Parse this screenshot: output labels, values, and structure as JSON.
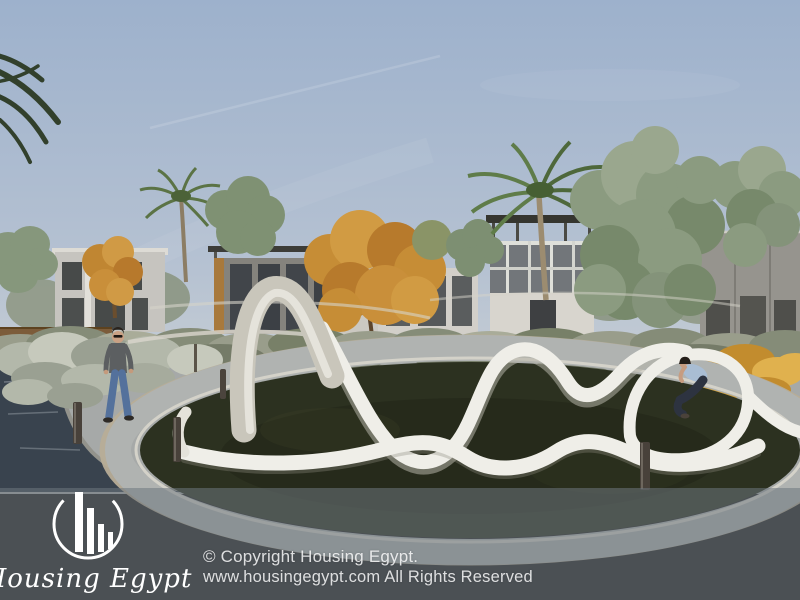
{
  "brand": {
    "name": "Housing Egypt",
    "logo_icon": "circle-with-building-bars-icon",
    "logo_color": "#ffffff"
  },
  "footer": {
    "copyright_line1": "© Copyright Housing Egypt.",
    "copyright_line2": "www.housingegypt.com All Rights Reserved",
    "overlay_color": "rgba(110,118,126,0.55)",
    "text_color": "rgba(255,255,255,0.82)"
  },
  "scene": {
    "colors": {
      "sky_top": "#9db1cc",
      "sky_horizon": "#d3d5d2",
      "lawn": "#2c3120",
      "water": "#39434e",
      "walkway": "#a6a9a8",
      "gravel": "#b7ad97",
      "sculpture": "#efeee8",
      "shrubs": "#8e9483",
      "autumn_foliage": "#c68d36",
      "yellow_shrub": "#d2a13e"
    }
  }
}
